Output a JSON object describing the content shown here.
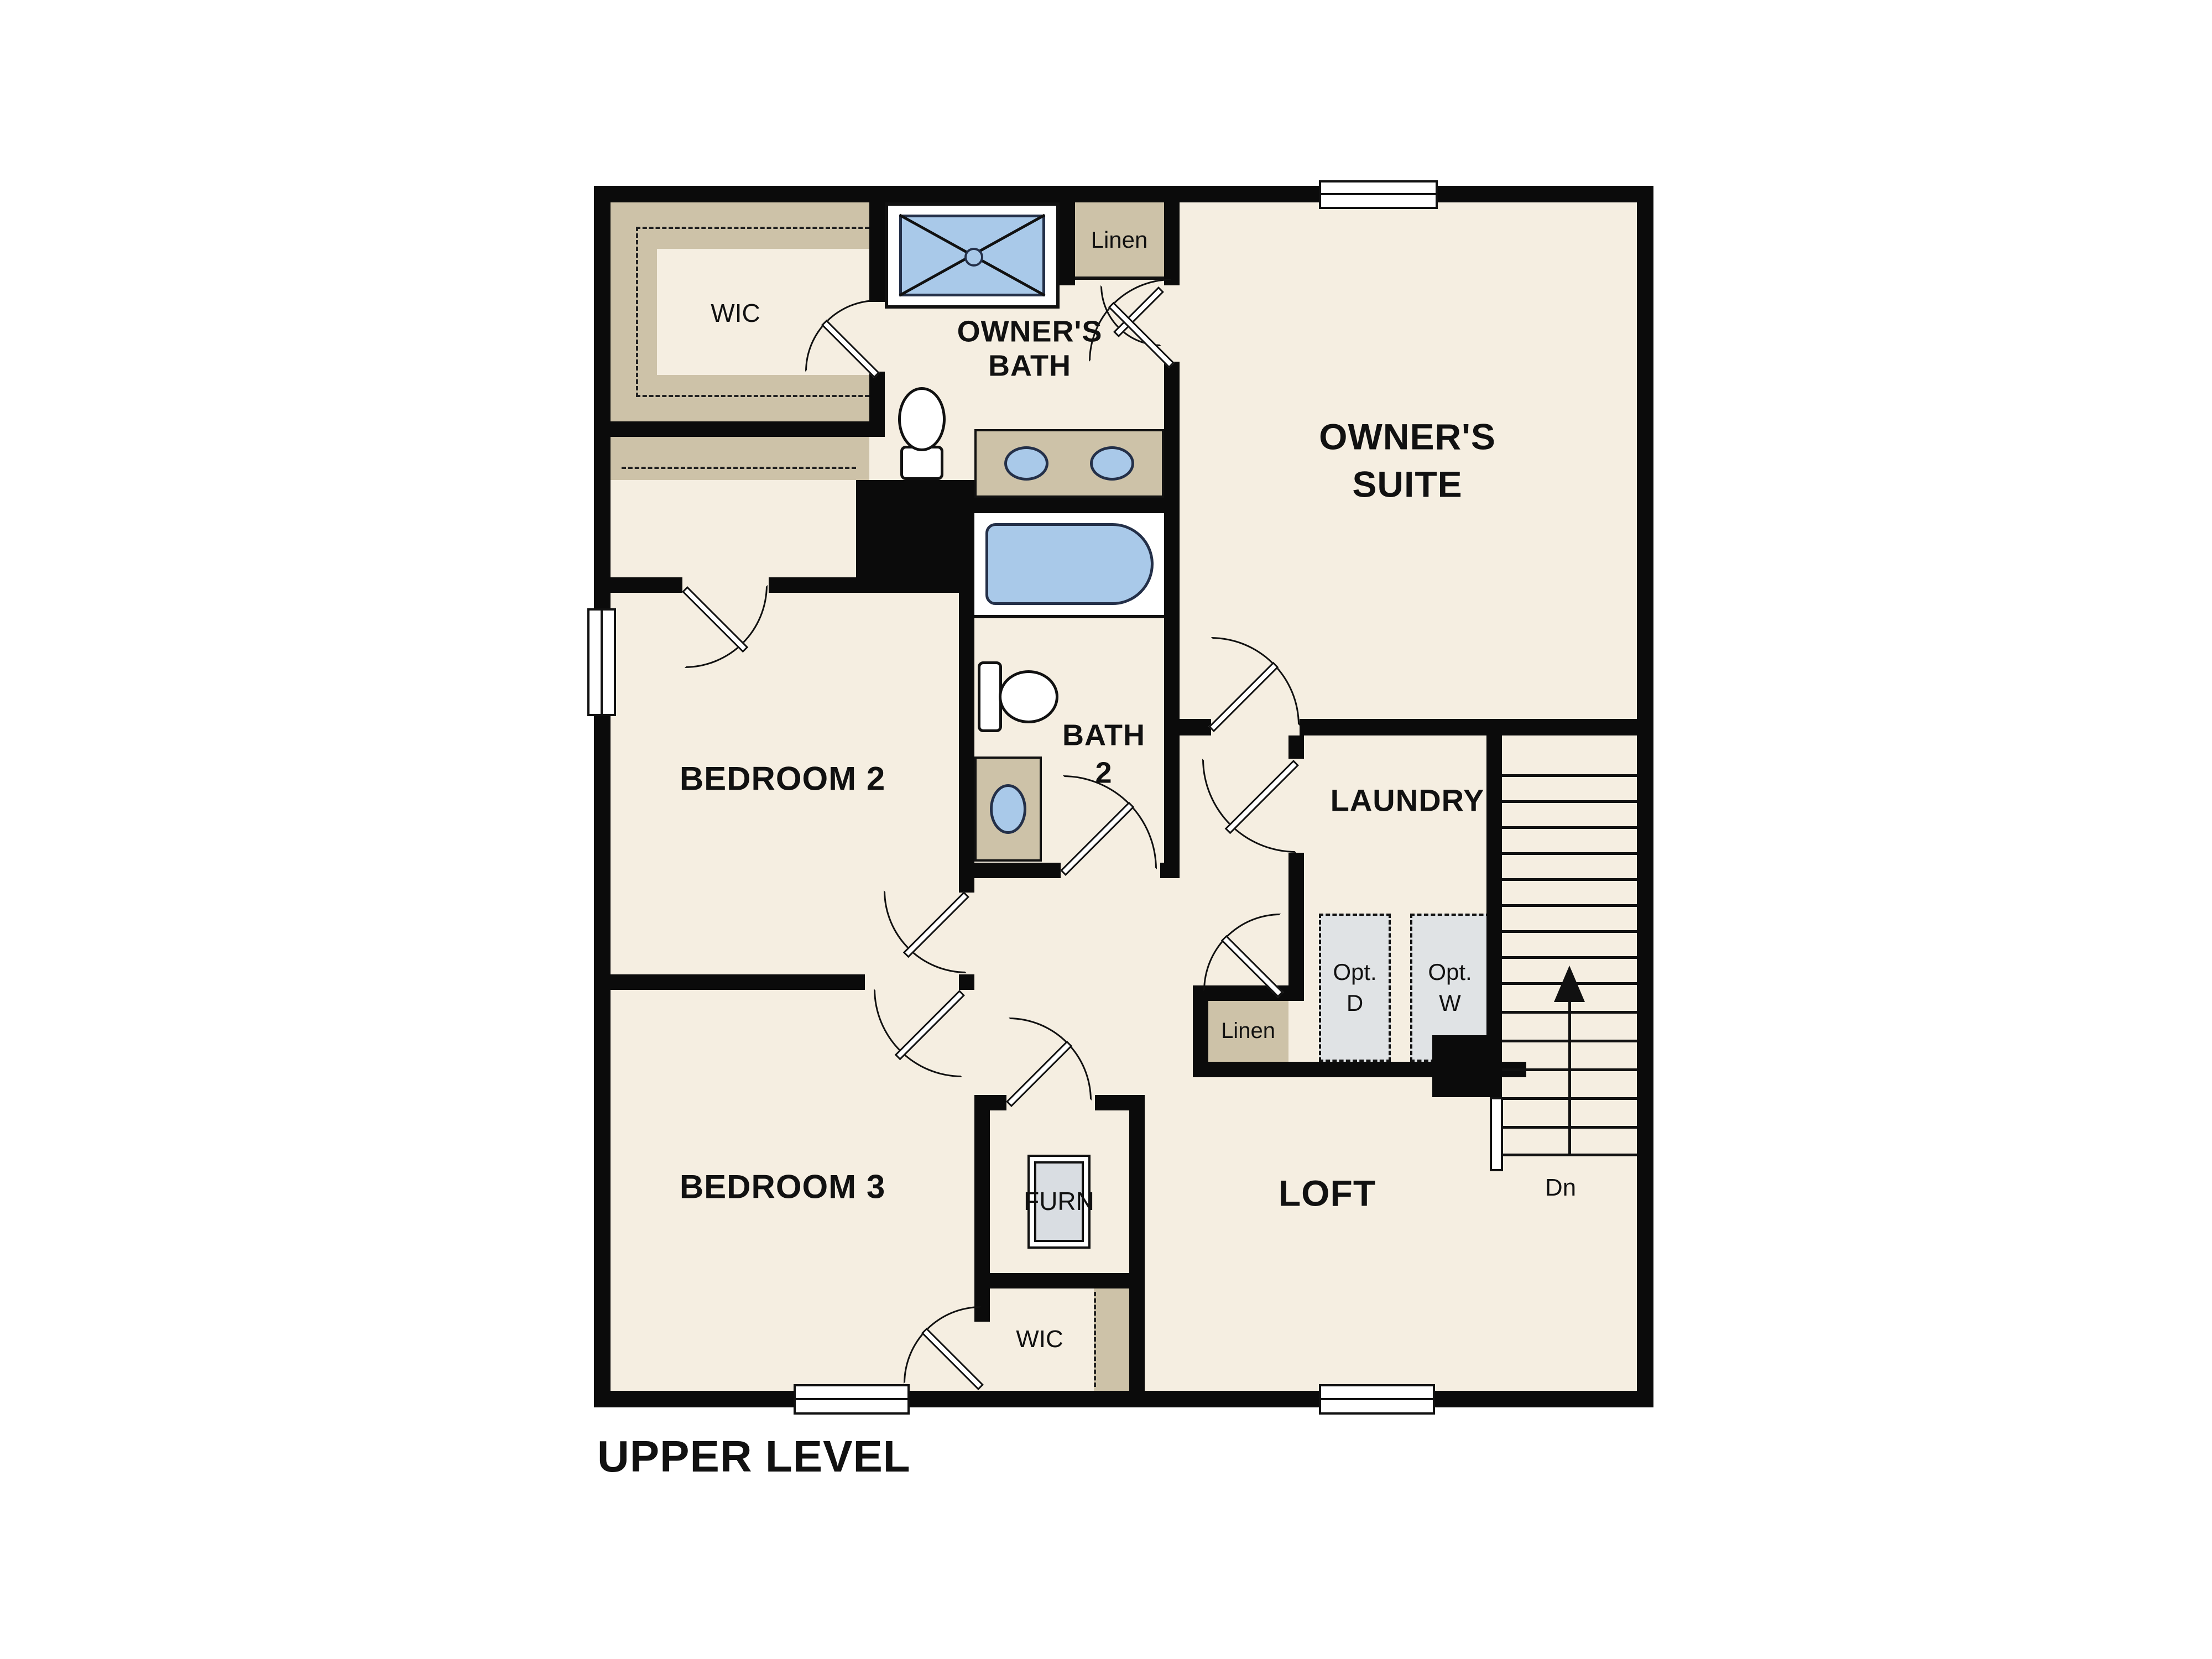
{
  "title": "UPPER LEVEL",
  "colors": {
    "floor": "#f5eee1",
    "wall": "#0b0b0b",
    "closet_tan": "#cdc2a8",
    "fixture_blue": "#a9c9e9",
    "fixture_outline": "#243049",
    "appliance_gray": "#e0e3e5"
  },
  "rooms": {
    "wic_owner": "WIC",
    "owners_bath": {
      "line1": "OWNER'S",
      "line2": "BATH"
    },
    "owners_suite": {
      "line1": "OWNER'S",
      "line2": "SUITE"
    },
    "bedroom2": "BEDROOM 2",
    "bath2": {
      "line1": "BATH",
      "line2": "2"
    },
    "laundry": "LAUNDRY",
    "bedroom3": "BEDROOM 3",
    "loft": "LOFT",
    "wic_bed3": "WIC"
  },
  "closets": {
    "linen_top": "Linen",
    "linen_hall": "Linen"
  },
  "equipment": {
    "furnace": "FURN",
    "opt_dryer": {
      "line1": "Opt.",
      "line2": "D"
    },
    "opt_washer": {
      "line1": "Opt.",
      "line2": "W"
    }
  },
  "stairs": {
    "down_label": "Dn"
  }
}
